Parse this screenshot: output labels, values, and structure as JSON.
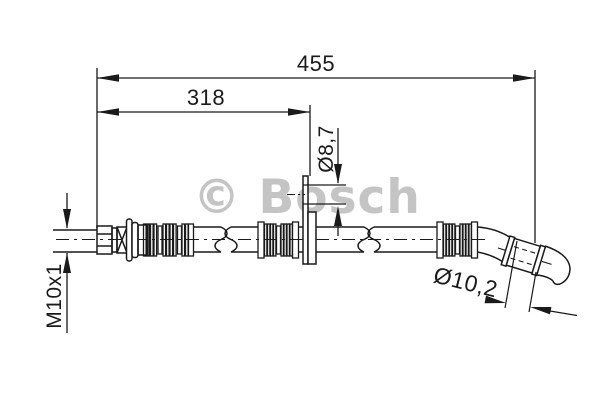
{
  "drawing": {
    "background": "#ffffff",
    "line_color": "#1a1a1a",
    "watermark": {
      "text": "© Bosch",
      "color": "#c4c4c4"
    },
    "dimensions": {
      "overall_length": "455",
      "length_to_bracket": "318",
      "bracket_hole_diameter": "Ø8,7",
      "thread_size": "M10x1",
      "hose_outer_diameter": "Ø10,2"
    }
  }
}
